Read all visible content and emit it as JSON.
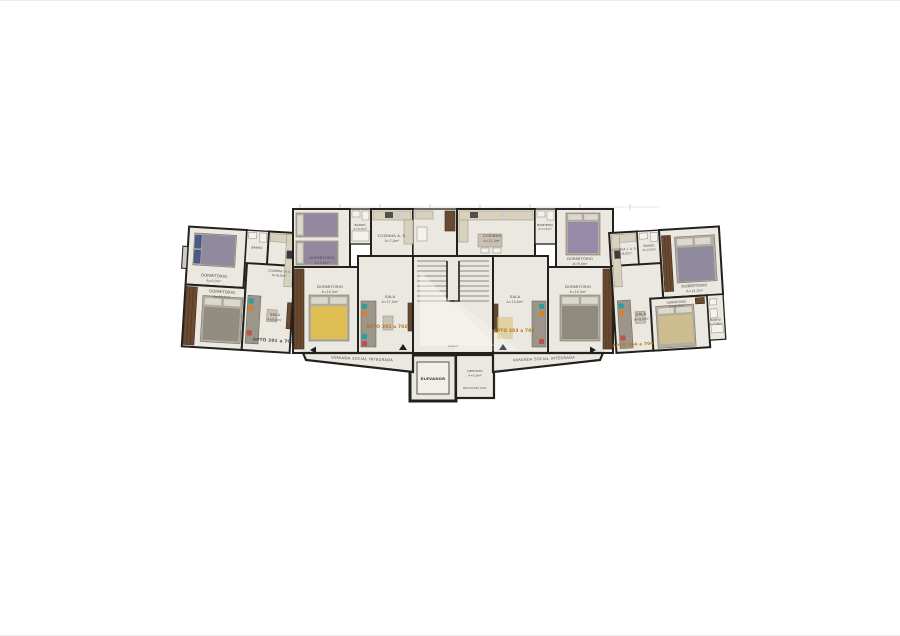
{
  "page": {
    "background": "#ffffff"
  },
  "plan": {
    "colors": {
      "wall": "#23211d",
      "floor": "#eae8e0",
      "accent_apto": "#b5761f",
      "wood": "#6a4a30",
      "counter": "#d8d1bd",
      "yellow_bed": "#e2bf49"
    },
    "varanda_label": "VARANDA SOCIAL INTEGRADA",
    "core": {
      "elevador": "ELEVADOR",
      "deposito_name": "DEPÓSITO",
      "deposito_area": "A=2,0m²",
      "medidores": "MEDIDORES ELET.",
      "comum": "COMUM"
    },
    "units": [
      {
        "id": "201",
        "label": "APTO 201 a 701"
      },
      {
        "id": "202",
        "label": "APTO 202 a 702"
      },
      {
        "id": "203",
        "label": "APTO 203 a 703"
      },
      {
        "id": "204",
        "label": "APTO 204 a 704"
      }
    ],
    "rooms": {
      "u201_dorm1": {
        "name": "DORMITÓRIO",
        "area": "A=9,0m²"
      },
      "u201_banho": {
        "name": "BANHO",
        "area": ""
      },
      "u201_cozinha": {
        "name": "COZINHA / A.S.",
        "area": "A=6,0m²"
      },
      "u201_dorm2": {
        "name": "DORMITÓRIO",
        "area": "A=10,5m²"
      },
      "u201_sala": {
        "name": "SALA",
        "area": "A=9,0m²"
      },
      "u202_dorm1": {
        "name": "DORMITÓRIO",
        "area": "A=9,0m²"
      },
      "u202_banho": {
        "name": "BANHO",
        "area": "A=3,5m²"
      },
      "u202_cozinha": {
        "name": "COZINHA A. S.",
        "area": "A=7,0m²"
      },
      "u202_dorm2": {
        "name": "DORMITÓRIO",
        "area": "A=10,5m²"
      },
      "u202_sala": {
        "name": "SALA",
        "area": "A=17,0m²"
      },
      "u203_cozinha": {
        "name": "COZINHA",
        "area": "A=11,0m²"
      },
      "u203_banho": {
        "name": "BANHEIRO",
        "area": "A=3,5m²"
      },
      "u203_dorm1": {
        "name": "DORMITÓRIO",
        "area": "A=9,0m²"
      },
      "u203_dorm2": {
        "name": "DORMITÓRIO",
        "area": "A=10,5m²"
      },
      "u203_sala": {
        "name": "SALA",
        "area": "A=15,0m²"
      },
      "u204_cozinha": {
        "name": "COZINHA + A. S.",
        "area": "A=8,0m²"
      },
      "u204_banho1": {
        "name": "BANHO",
        "area": "A=2,0m²"
      },
      "u204_dorm1": {
        "name": "DORMITÓRIO",
        "area": "A=14,0m²"
      },
      "u204_sala": {
        "name": "SALA",
        "area": "A=9,0m²"
      },
      "u204_dorm2": {
        "name": "DORMITÓRIO",
        "area": "A=10,5m²"
      },
      "u204_banho2": {
        "name": "BANHO",
        "area": "A=3,6m²"
      }
    }
  }
}
